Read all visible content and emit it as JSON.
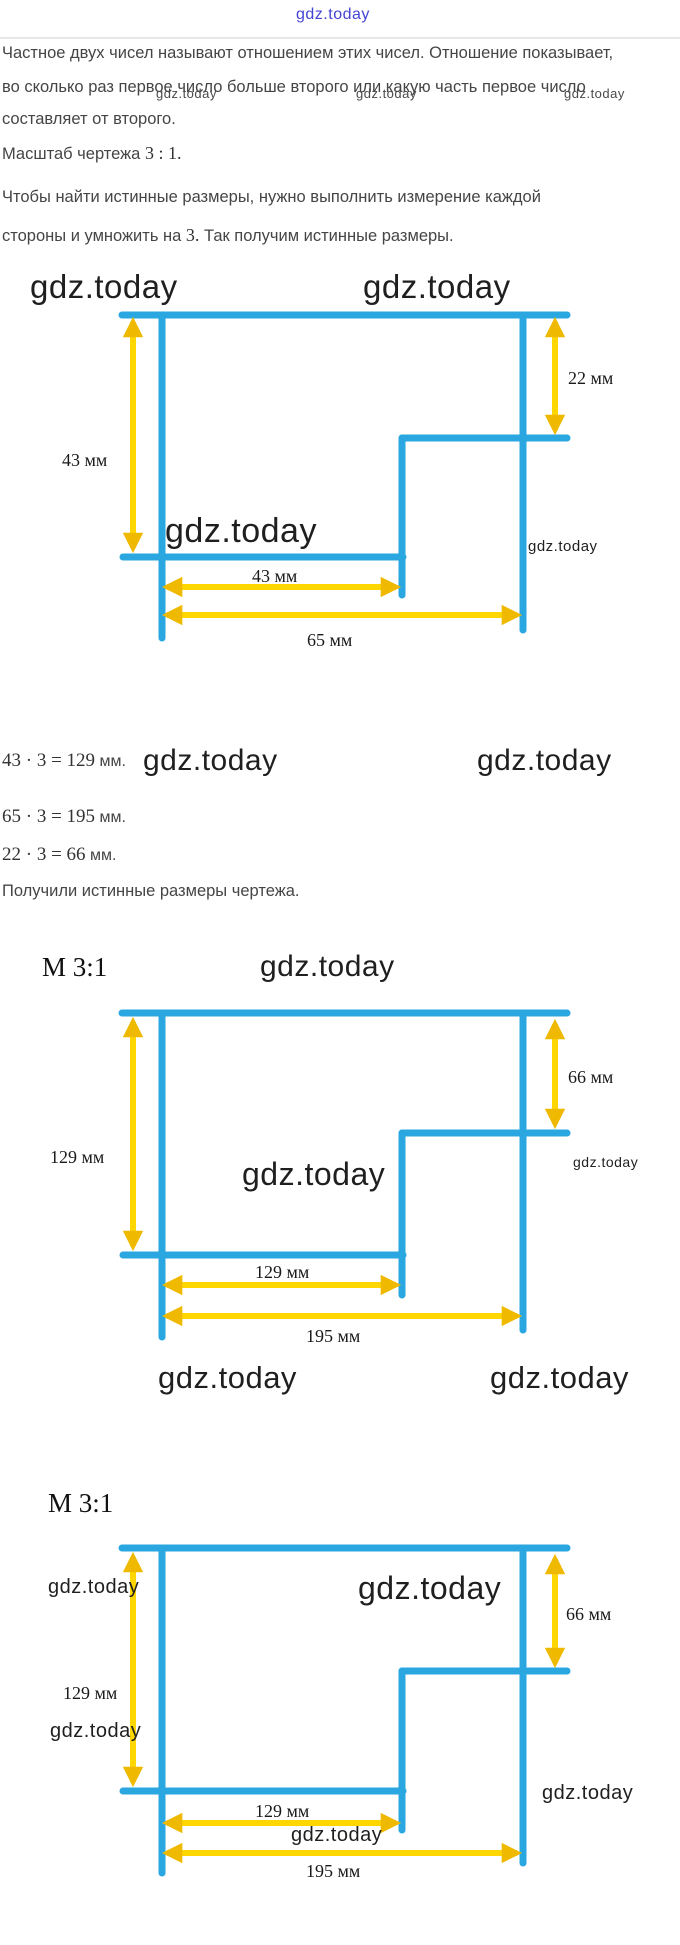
{
  "brand": {
    "watermark": "gdz.today"
  },
  "colors": {
    "cyan": "#2AA7E0",
    "yellow": "#FFD600",
    "arrowhead": "#EFB900",
    "blue_watermark": "#4444D4"
  },
  "intro": {
    "line1": "Частное двух чисел называют отношением этих чисел. Отношение показывает,",
    "line2": "во сколько раз первое число больше второго или какую часть первое число",
    "line3": "составляет от второго."
  },
  "scale_note": {
    "prefix": "Масштаб чертежа ",
    "math": "3 : 1."
  },
  "method": {
    "line1": "Чтобы найти истинные размеры, нужно выполнить измерение каждой",
    "line2_prefix": "стороны и умножить на ",
    "line2_math": "3.",
    "line2_suffix": " Так получим истинные размеры."
  },
  "calculations": {
    "calc1": {
      "math": "43 · 3 = 129",
      "unit": " мм."
    },
    "calc2": {
      "math": "65 · 3 = 195",
      "unit": " мм."
    },
    "calc3": {
      "math": "22 · 3 = 66",
      "unit": " мм."
    },
    "conclusion": "Получили истинные размеры чертежа."
  },
  "diagrams": {
    "original": {
      "dim_left": "43 мм",
      "dim_right": "22 мм",
      "dim_inner": "43 мм",
      "dim_bottom": "65 мм"
    },
    "scaled1": {
      "scale_label": "М 3:1",
      "dim_left": "129 мм",
      "dim_right": "66 мм",
      "dim_inner": "129 мм",
      "dim_bottom": "195 мм"
    },
    "scaled2": {
      "scale_label": "М 3:1",
      "dim_left": "129 мм",
      "dim_right": "66 мм",
      "dim_inner": "129 мм",
      "dim_bottom": "195 мм"
    }
  }
}
